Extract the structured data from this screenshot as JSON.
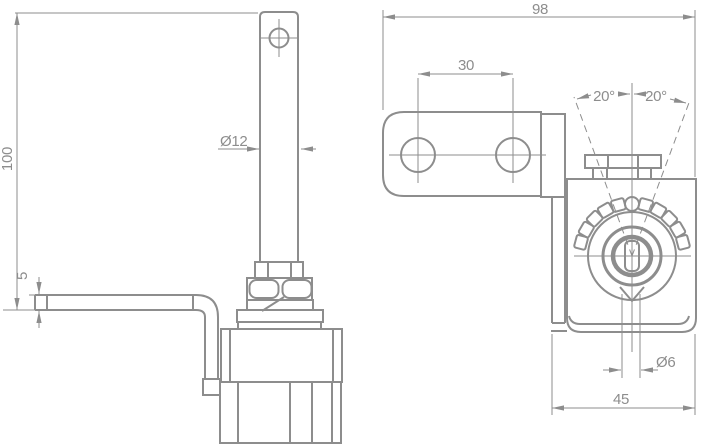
{
  "drawing": {
    "type": "technical-orthographic-drawing",
    "background_color": "#ffffff",
    "line_color": "#8d8d8d",
    "views": {
      "side_view_name": "side-view",
      "front_view_name": "front-view"
    },
    "dimensions": {
      "overall_height": "100",
      "plate_thickness": "5",
      "rod_diameter": "Ø12",
      "overall_width": "98",
      "hole_spacing": "30",
      "angle_left": "20°",
      "angle_right": "20°",
      "hole_diameter": "Ø6",
      "body_width": "45"
    }
  }
}
